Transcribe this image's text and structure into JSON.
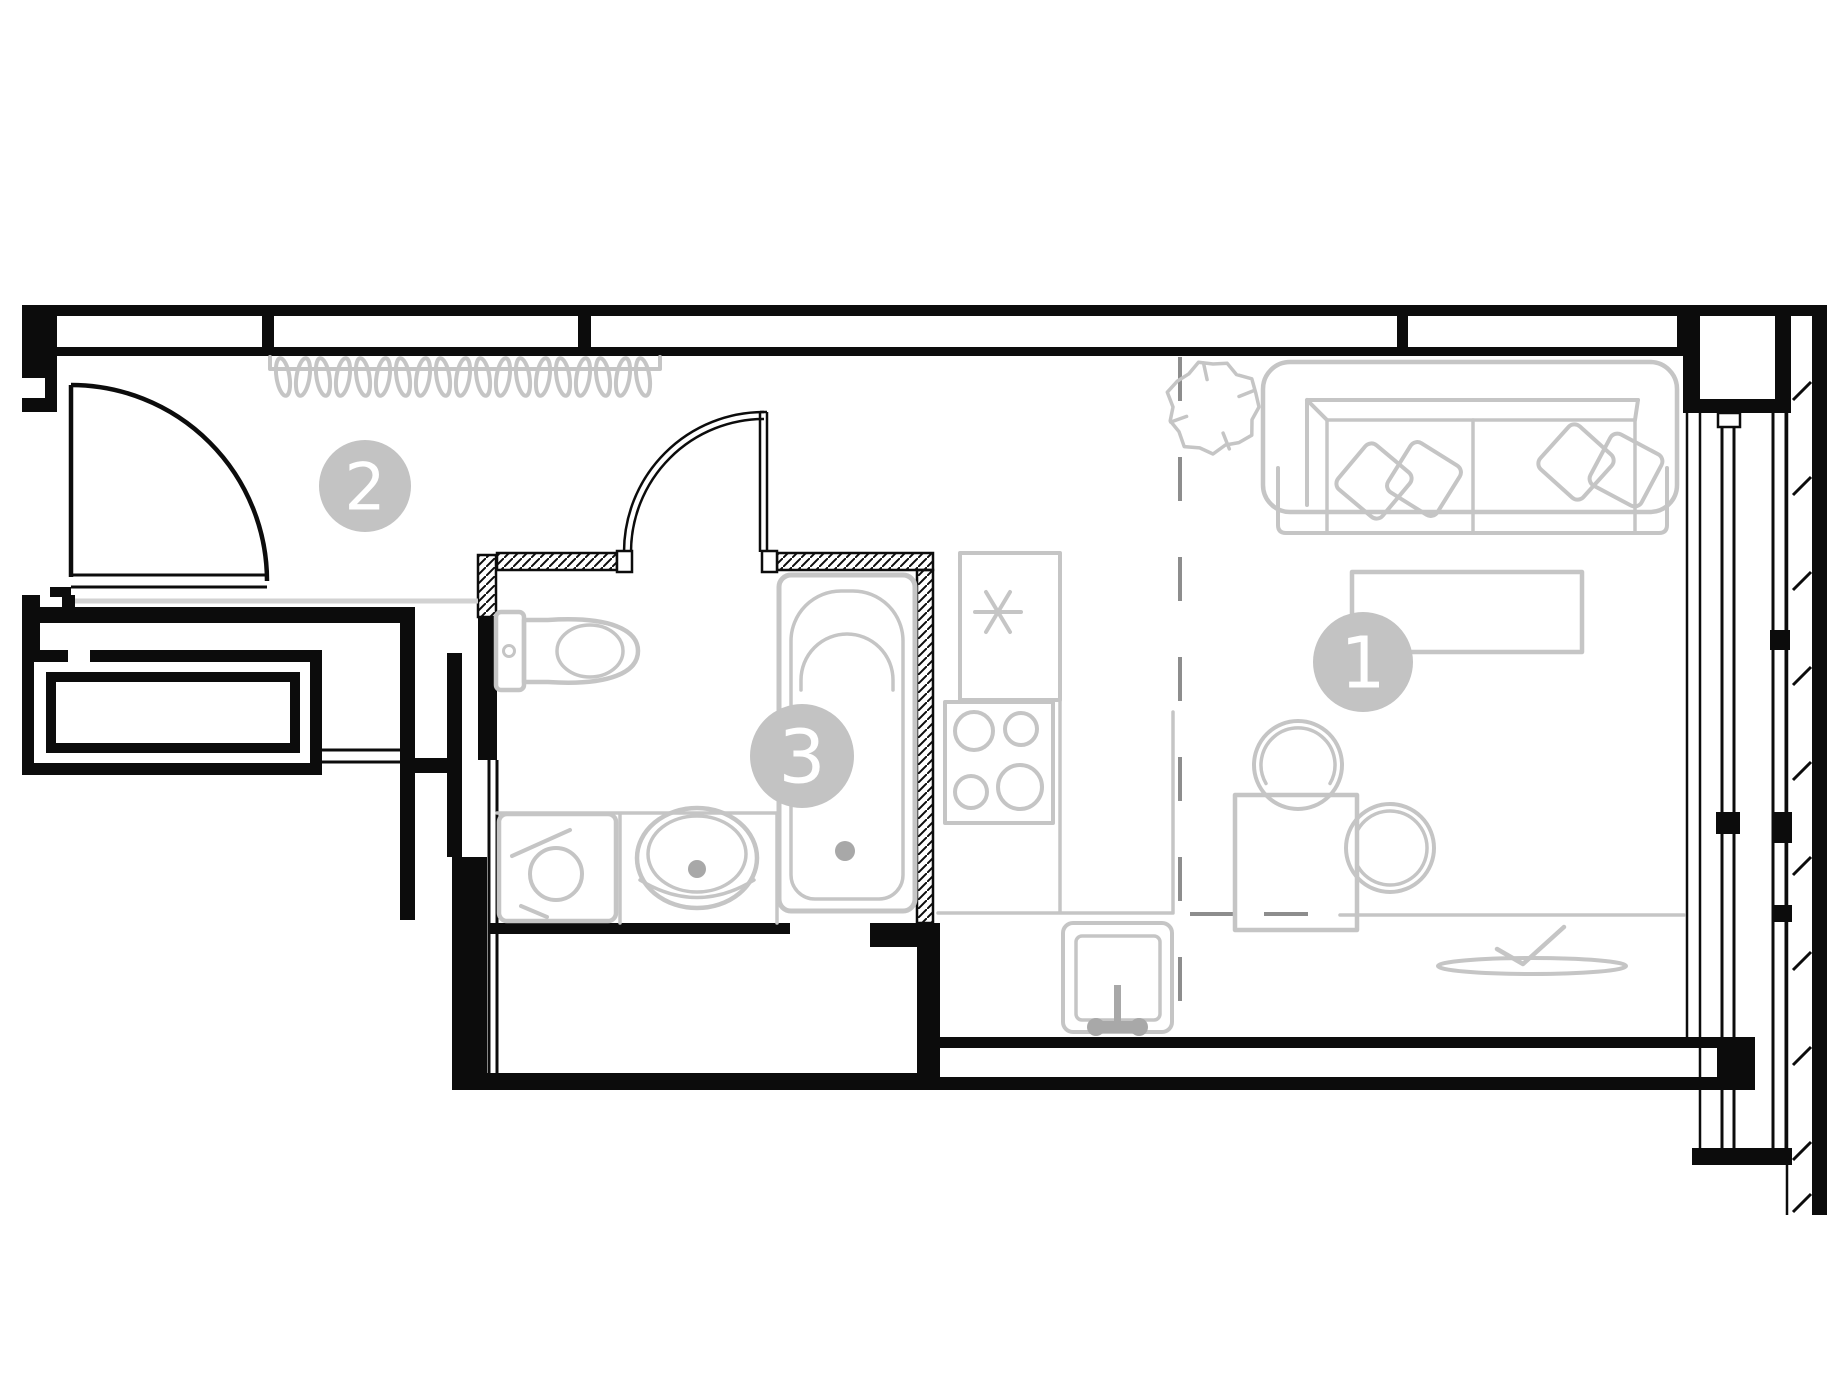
{
  "colors": {
    "background": "#ffffff",
    "wall": "#0c0c0c",
    "furniture": "#c5c5c5",
    "furniture_dark": "#a8a8a8",
    "floor_line": "#d2d2d2",
    "divider": "#8d8d8d",
    "label_bg": "#c3c3c3",
    "label_text": "#ffffff"
  },
  "room_labels": [
    {
      "id": "room-1-living-kitchen",
      "number": "1",
      "cx": 1363,
      "cy": 662,
      "r": 50
    },
    {
      "id": "room-2-hallway",
      "number": "2",
      "cx": 365,
      "cy": 486,
      "r": 46
    },
    {
      "id": "room-3-bathroom",
      "number": "3",
      "cx": 802,
      "cy": 756,
      "r": 52
    }
  ],
  "decor": {
    "hanger_count": 19,
    "plant_center": {
      "x": 1213,
      "y": 407
    },
    "plant_radius": 45
  },
  "furniture_items": [
    "coat-rack-with-hangers",
    "entry-door",
    "bathroom-door",
    "toilet",
    "washing-machine",
    "bathroom-sink",
    "bathtub",
    "refrigerator-symbol",
    "stove",
    "kitchen-counter",
    "kitchen-sink",
    "sofa",
    "pillows",
    "plant",
    "desk",
    "dining-table",
    "chairs",
    "tv-console",
    "decor-dish",
    "window-strip",
    "zone-divider"
  ]
}
